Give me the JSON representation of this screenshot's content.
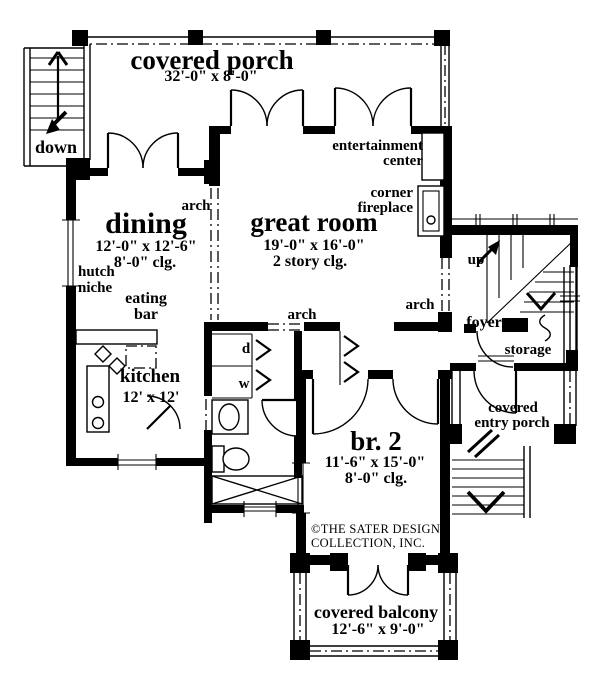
{
  "rooms": {
    "covered_porch": {
      "label": "covered porch",
      "dims": "32'-0\" x 8'-0\""
    },
    "dining": {
      "label": "dining",
      "dims": "12'-0\" x 12'-6\"",
      "ceiling": "8'-0\" clg."
    },
    "great_room": {
      "label": "great room",
      "dims": "19'-0\" x 16'-0\"",
      "ceiling": "2 story clg."
    },
    "kitchen": {
      "label": "kitchen",
      "dims": "12' x 12'"
    },
    "br2": {
      "label": "br. 2",
      "dims": "11'-6\" x 15'-0\"",
      "ceiling": "8'-0\" clg."
    },
    "covered_balcony": {
      "label": "covered balcony",
      "dims": "12'-6\" x 9'-0\""
    },
    "covered_entry_porch": {
      "line1": "covered",
      "line2": "entry porch"
    },
    "foyer": {
      "label": "foyer"
    },
    "storage": {
      "label": "storage"
    }
  },
  "features": {
    "entertainment_center": {
      "line1": "entertainment",
      "line2": "center"
    },
    "corner_fireplace": {
      "line1": "corner",
      "line2": "fireplace"
    },
    "hutch_niche": {
      "line1": "hutch",
      "line2": "niche"
    },
    "eating_bar": {
      "line1": "eating",
      "line2": "bar"
    },
    "arch": "arch",
    "down": "down",
    "up": "up",
    "dryer": "d",
    "washer": "w"
  },
  "copyright": {
    "line1": "©THE SATER DESIGN",
    "line2": "COLLECTION, INC."
  },
  "colors": {
    "ink": "#000000",
    "paper": "#ffffff"
  }
}
